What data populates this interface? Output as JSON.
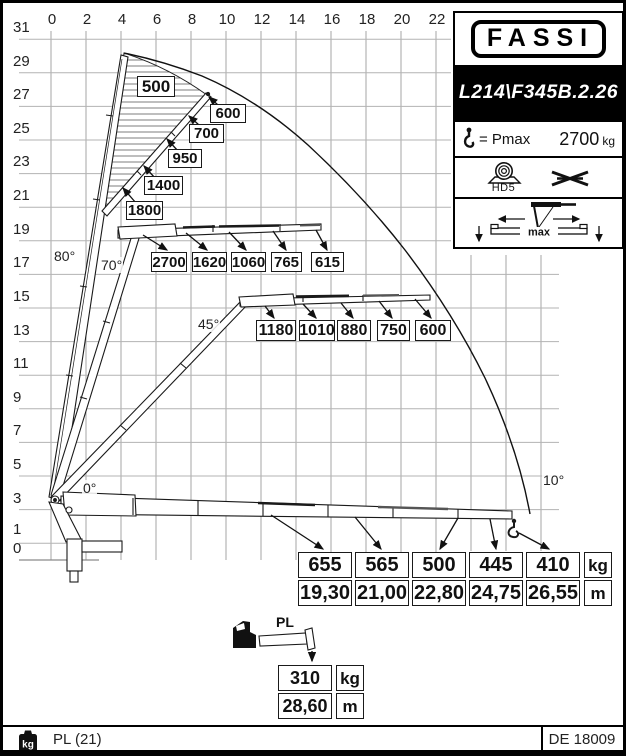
{
  "axes": {
    "x": [
      "0",
      "2",
      "4",
      "6",
      "8",
      "10",
      "12",
      "14",
      "16",
      "18",
      "20",
      "22"
    ],
    "y": [
      "31",
      "29",
      "27",
      "25",
      "23",
      "21",
      "19",
      "17",
      "15",
      "13",
      "11",
      "9",
      "7",
      "5",
      "3",
      "1",
      "0"
    ]
  },
  "angles": {
    "deg80": "80°",
    "deg70": "70°",
    "deg45": "45°",
    "deg0": "0°",
    "deg10": "10°"
  },
  "vertical_zone_loads_kg": [
    "500",
    "600",
    "700",
    "950",
    "1400",
    "1800"
  ],
  "row70_loads_kg": [
    "2700",
    "1620",
    "1060",
    "765",
    "615"
  ],
  "row45_loads_kg": [
    "1180",
    "1010",
    "880",
    "750",
    "600"
  ],
  "outreach_table": {
    "loads_kg": [
      "655",
      "565",
      "500",
      "445",
      "410"
    ],
    "distances_m": [
      "19,30",
      "21,00",
      "22,80",
      "24,75",
      "26,55"
    ],
    "unit_load": "kg",
    "unit_distance": "m"
  },
  "pl_extension": {
    "label": "PL",
    "load_kg": "310",
    "distance_m": "28,60",
    "unit_load": "kg",
    "unit_distance": "m"
  },
  "panel": {
    "brand": "FASSI",
    "model": "L214\\F345B.2.26",
    "pmax_label": "= Pmax",
    "pmax_value": "2700",
    "pmax_unit": "kg",
    "winch_label": "HD5",
    "stabilizer_label": "max"
  },
  "footer": {
    "left_text": "PL (21)",
    "right_text": "DE 18009",
    "weight_icon_text": "kg"
  }
}
